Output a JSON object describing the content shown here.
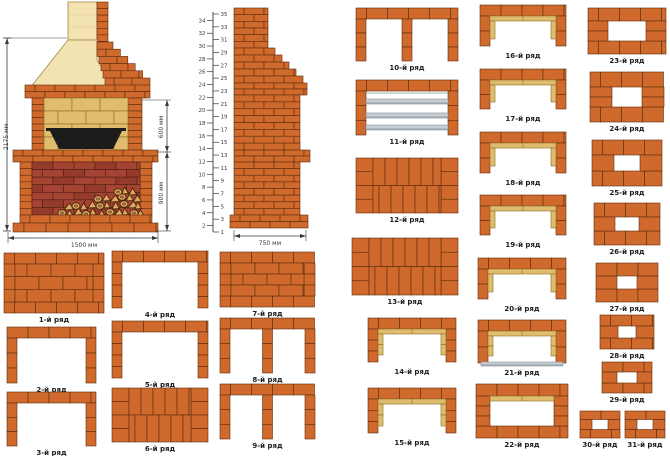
{
  "colors": {
    "brick": "#d06a2c",
    "brick_stroke": "#5d2c10",
    "red_brick": "#a64434",
    "red_brick_alt": "#953b2c",
    "red_stroke": "#4f1d10",
    "cream": "#f4e3b2",
    "cream_stroke": "#a5854a",
    "tan": "#e0bd6e",
    "tan_stroke": "#8f6b23",
    "metal_gray": "#c6ced4",
    "metal_stroke": "#87919a",
    "wood": "#dfa75f",
    "wood_stroke": "#3f2208",
    "tray_black": "#1c1c1c",
    "dim": "#3a3a3a",
    "label": "#1d1d1d"
  },
  "front_view": {
    "dim_total_height": "2175 мм",
    "dim_firebox_height": "600 мм",
    "dim_base_height": "900 мм",
    "dim_width": "1500 мм"
  },
  "side_view": {
    "dim_depth": "750 мм"
  },
  "ruler": {
    "min": 1,
    "max": 35
  },
  "rows": [
    {
      "n": 1,
      "label": "1-й ряд",
      "type": "solid_mixed",
      "x": 4,
      "y": 253,
      "w": 100,
      "h": 60
    },
    {
      "n": 2,
      "label": "2-й ряд",
      "type": "u",
      "x": 7,
      "y": 327,
      "w": 89,
      "h": 56
    },
    {
      "n": 3,
      "label": "3-й ряд",
      "type": "u",
      "x": 7,
      "y": 392,
      "w": 89,
      "h": 54
    },
    {
      "n": 4,
      "label": "4-й ряд",
      "type": "u",
      "x": 112,
      "y": 251,
      "w": 96,
      "h": 57
    },
    {
      "n": 5,
      "label": "5-й ряд",
      "type": "u",
      "x": 112,
      "y": 321,
      "w": 96,
      "h": 57
    },
    {
      "n": 6,
      "label": "6-й ряд",
      "type": "solid_vert",
      "x": 112,
      "y": 388,
      "w": 96,
      "h": 54
    },
    {
      "n": 7,
      "label": "7-й ряд",
      "type": "solid_mixed",
      "x": 220,
      "y": 252,
      "w": 95,
      "h": 55
    },
    {
      "n": 8,
      "label": "8-й ряд",
      "type": "u_mid",
      "x": 220,
      "y": 318,
      "w": 95,
      "h": 55
    },
    {
      "n": 9,
      "label": "9-й ряд",
      "type": "u_mid",
      "x": 220,
      "y": 384,
      "w": 95,
      "h": 55
    },
    {
      "n": 10,
      "label": "10-й ряд",
      "type": "u_mid",
      "x": 356,
      "y": 8,
      "w": 102,
      "h": 53
    },
    {
      "n": 11,
      "label": "11-й ряд",
      "type": "u_bars",
      "x": 356,
      "y": 80,
      "w": 102,
      "h": 55
    },
    {
      "n": 12,
      "label": "12-й ряд",
      "type": "solid_vert",
      "x": 356,
      "y": 158,
      "w": 102,
      "h": 55
    },
    {
      "n": 13,
      "label": "13-й ряд",
      "type": "solid_vert",
      "x": 352,
      "y": 238,
      "w": 106,
      "h": 57
    },
    {
      "n": 14,
      "label": "14-й ряд",
      "type": "u_lined",
      "x": 368,
      "y": 318,
      "w": 88,
      "h": 47
    },
    {
      "n": 15,
      "label": "15-й ряд",
      "type": "u_lined",
      "x": 368,
      "y": 388,
      "w": 88,
      "h": 48
    },
    {
      "n": 16,
      "label": "16-й ряд",
      "type": "u_lined",
      "x": 480,
      "y": 5,
      "w": 86,
      "h": 44
    },
    {
      "n": 17,
      "label": "17-й ряд",
      "type": "u_lined",
      "x": 480,
      "y": 69,
      "w": 86,
      "h": 43
    },
    {
      "n": 18,
      "label": "18-й ряд",
      "type": "u_lined",
      "x": 480,
      "y": 132,
      "w": 86,
      "h": 44
    },
    {
      "n": 19,
      "label": "19-й ряд",
      "type": "u_lined",
      "x": 480,
      "y": 195,
      "w": 86,
      "h": 43
    },
    {
      "n": 20,
      "label": "20-й ряд",
      "type": "u_lined",
      "x": 478,
      "y": 258,
      "w": 88,
      "h": 44
    },
    {
      "n": 21,
      "label": "21-й ряд",
      "type": "u_lined_bar",
      "x": 478,
      "y": 320,
      "w": 88,
      "h": 46
    },
    {
      "n": 22,
      "label": "22-й ряд",
      "type": "o_lined",
      "x": 476,
      "y": 384,
      "w": 92,
      "h": 54
    },
    {
      "n": 23,
      "label": "23-й ряд",
      "type": "o_ring",
      "x": 588,
      "y": 8,
      "w": 78,
      "h": 46,
      "hw": 38,
      "hh": 20
    },
    {
      "n": 24,
      "label": "24-й ряд",
      "type": "o_ring",
      "x": 590,
      "y": 72,
      "w": 74,
      "h": 50,
      "hw": 30,
      "hh": 20
    },
    {
      "n": 25,
      "label": "25-й ряд",
      "type": "o_ring",
      "x": 592,
      "y": 140,
      "w": 70,
      "h": 46,
      "hw": 26,
      "hh": 16
    },
    {
      "n": 26,
      "label": "26-й ряд",
      "type": "o_ring",
      "x": 594,
      "y": 203,
      "w": 66,
      "h": 42,
      "hw": 24,
      "hh": 14
    },
    {
      "n": 27,
      "label": "27-й ряд",
      "type": "o_ring",
      "x": 596,
      "y": 263,
      "w": 62,
      "h": 39,
      "hw": 20,
      "hh": 13
    },
    {
      "n": 28,
      "label": "28-й ряд",
      "type": "o_ring",
      "x": 600,
      "y": 315,
      "w": 54,
      "h": 34,
      "hw": 18,
      "hh": 12
    },
    {
      "n": 29,
      "label": "29-й ряд",
      "type": "o_ring",
      "x": 602,
      "y": 362,
      "w": 50,
      "h": 31,
      "hw": 20,
      "hh": 11
    },
    {
      "n": 30,
      "label": "30-й ряд",
      "type": "o_ring",
      "x": 580,
      "y": 411,
      "w": 40,
      "h": 27,
      "hw": 16,
      "hh": 10
    },
    {
      "n": 31,
      "label": "31-й ряд",
      "type": "o_ring",
      "x": 625,
      "y": 411,
      "w": 40,
      "h": 27,
      "hw": 16,
      "hh": 10
    }
  ]
}
